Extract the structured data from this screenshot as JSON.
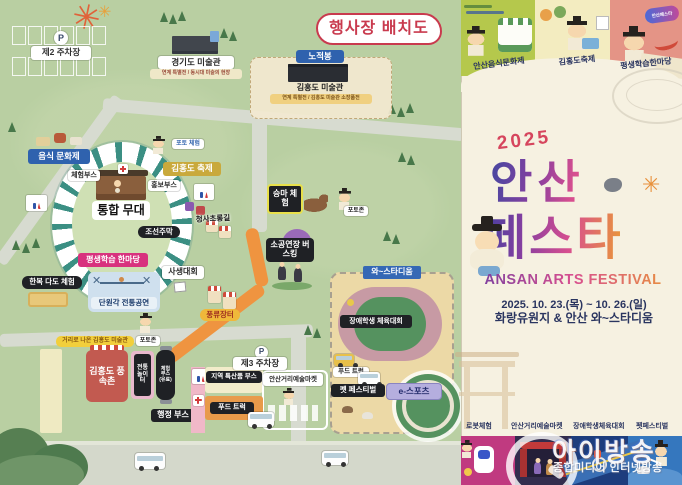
{
  "title": "행사장 배치도",
  "map": {
    "parking2_label": "제2 주차장",
    "parking3_label": "제3 주차장",
    "parking_icon": "P",
    "gyeonggi_museum": "경기도 미술관",
    "gyeonggi_museum_sub": "연계 특별전 / 동시대 미술의 현장",
    "nojeokbong": "노적봉",
    "kimhongdo_museum": "김홍도 미술관",
    "kimhongdo_museum_sub": "연계 특별전 / 김홍도 미술관 소장품전",
    "food_culture_festival": "음식 문화제",
    "experience_booth": "체험부스",
    "promotion_booth": "홍보부스",
    "photo_experience": "포토 체험",
    "kimhongdo_festival": "김홍도 축제",
    "main_stage": "통합 무대",
    "joseon_tavern": "조선주막",
    "lantern_road": "청사초롱길",
    "lifelong_learning": "평생학습 한마당",
    "sketch_contest": "사생대회",
    "hanbok_tea": "한복 다도 체험",
    "danwongak_performance": "단원각 전통공연",
    "pungnyu_market": "풍류장터",
    "street_museum": "거리로 나온 김홍도 미술관",
    "photozone_a": "포토존",
    "photozone_b": "포토존",
    "horse_riding": "승마 체험",
    "busking": "소공연장 버스킹",
    "folk_village": "김홍도 풍속촌",
    "traditional_playground": "전통 놀이터",
    "paid_booth": "체험 부스 (유료)",
    "admin_booth": "행정 부스",
    "local_goods_booth": "지역 특산품 부스",
    "street_art_market": "안산거리예술마켓",
    "food_truck_a": "푸드 트럭",
    "food_truck_b": "푸드 트럭",
    "wa_stadium": "와~스타디움",
    "disabled_sports": "장애학생 체육대회",
    "pet_festival": "펫 페스티벌",
    "esports": "e-스포츠"
  },
  "poster": {
    "year": "2025",
    "title_line1": "안산",
    "title_line2": "페스타",
    "subtitle_en": "ANSAN ARTS FESTIVAL",
    "dates": "2025. 10. 23.(목) ~ 10. 26.(일)",
    "venue": "화랑유원지 & 안산 와~스타디움",
    "panel_food": "안산음식문화제",
    "panel_kimhongdo": "김홍도축제",
    "panel_learning": "평생학습한마당",
    "event_robot": "로봇체험",
    "event_street_market": "안산거리예술마켓",
    "event_disabled_sports": "장애학생체육대회",
    "event_pet": "펫페스티벌",
    "badge": "안산페스타"
  },
  "watermark": {
    "brand": "아이방송",
    "subtitle": "종합미디어 인터넷방송"
  },
  "colors": {
    "map_bg": "#b9cfa2",
    "road": "#d7dbd0",
    "orange_path": "#ef9440",
    "title_red": "#c93a4e",
    "label_blue": "#2f62ae",
    "festival_gold": "#c9a93c",
    "lifelong_pink": "#d8327e",
    "folk_red": "#c25a50",
    "stadium_sand": "#ecd9a6",
    "poster_cream": "#f6f1e1",
    "panel_green": "#b5c84c",
    "panel_yellow": "#f3ecc0",
    "panel_salmon": "#e49486",
    "panel_magenta": "#c03a80",
    "panel_navy": "#332d4e",
    "panel_blue_dark": "#1d3d7d",
    "panel_blue": "#3577be",
    "esports_lavender": "#b5aede"
  }
}
